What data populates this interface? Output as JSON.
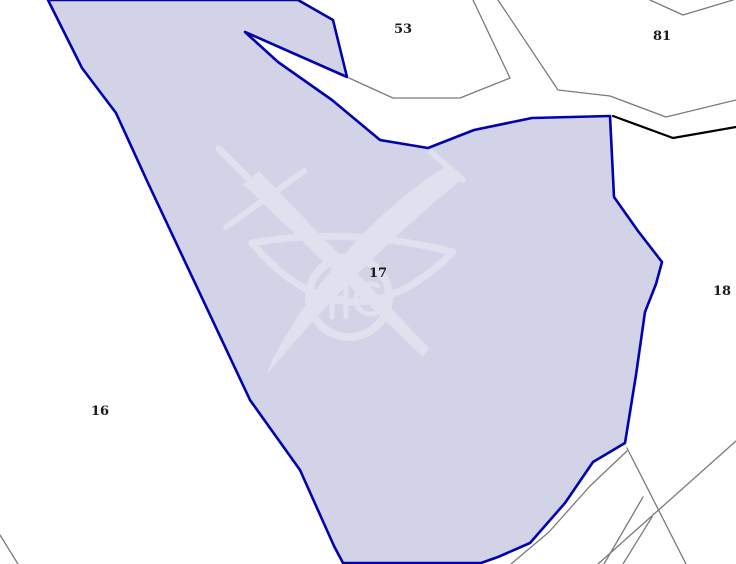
{
  "map": {
    "width": 736,
    "height": 564,
    "background_color": "#ffffff",
    "colors": {
      "parcel_fill": "#d2d3e6",
      "parcel_stroke": "#0202ae",
      "boundary_gray": "#7a7a7a",
      "boundary_black": "#000000",
      "label_color": "#1a1a1a",
      "watermark_color": "#dfe1ee"
    },
    "selected_parcel": {
      "id": "17",
      "points": "48,0 298,0 333,20 347,77 245,32 278,62 332,100 380,140 428,148 474,130 532,118 610,116 614,197 638,231 662,262 656,284 645,312 636,375 625,443 593,462 565,503 530,543 498,557 481,563 343,563 334,546 300,470 250,400 148,183 116,113 82,68",
      "stroke_width": 2.6
    },
    "line_styles": {
      "gray": {
        "color": "#7a7a7a",
        "width": 1.3
      },
      "black": {
        "color": "#000000",
        "width": 2.2
      }
    },
    "boundaries": [
      {
        "name": "parcel-53-boundary",
        "style": "gray",
        "points": "349,78 393,98 460,98 510,78 473,0"
      },
      {
        "name": "road-upper-boundary",
        "style": "gray",
        "points": "498,0 558,90 610,96 666,117 736,100"
      },
      {
        "name": "top-right-notch-boundary",
        "style": "gray",
        "points": "650,0 683,15 733,0"
      },
      {
        "name": "parcel-18-black-boundary",
        "style": "black",
        "points": "613,116 673,138 736,127"
      },
      {
        "name": "bottom-left-corner-boundary",
        "style": "gray",
        "points": "0,535 18,564"
      },
      {
        "name": "road-edge-parallel-boundary",
        "style": "gray",
        "points": "627,451 590,486 549,532 511,564"
      },
      {
        "name": "southeast-branch-boundary",
        "style": "gray",
        "points": "627,448 686,564"
      },
      {
        "name": "narrow-strip-west-boundary",
        "style": "gray",
        "points": "643,497 604,564"
      },
      {
        "name": "narrow-strip-east-boundary",
        "style": "gray",
        "points": "652,517 623,564"
      },
      {
        "name": "southeast-diagonal-boundary",
        "style": "gray",
        "points": "736,441 598,564"
      }
    ],
    "labels": [
      {
        "id": "53",
        "text": "53",
        "x": 403,
        "y": 33
      },
      {
        "id": "81",
        "text": "81",
        "x": 662,
        "y": 40
      },
      {
        "id": "17",
        "text": "17",
        "x": 378,
        "y": 277
      },
      {
        "id": "16",
        "text": "16",
        "x": 100,
        "y": 415
      },
      {
        "id": "18",
        "text": "18",
        "x": 722,
        "y": 295
      }
    ],
    "label_style": {
      "font_size": 13
    },
    "watermark": {
      "icon_name": "crossed-sword-saber-emblem-icon",
      "shapes": [
        {
          "kind": "stroke",
          "d": "M219,149 L247,177",
          "width": 7
        },
        {
          "kind": "stroke",
          "d": "M304,171 L226,227",
          "width": 6
        },
        {
          "kind": "fill",
          "d": "M243,184 L259,171 L429,348 L423,357 Z"
        },
        {
          "kind": "fill",
          "d": "M446,166 Q340,234 272,360 L267,374 Q362,260 460,181 Z"
        },
        {
          "kind": "stroke",
          "d": "M431,152 L463,180",
          "width": 6
        },
        {
          "kind": "stroke",
          "d": "M252,243 Q350,226 453,252",
          "width": 7
        },
        {
          "kind": "stroke",
          "d": "M252,243 Q348,356 453,252",
          "width": 7
        },
        {
          "kind": "circle",
          "cx": 349,
          "cy": 297,
          "r": 40,
          "width": 8
        },
        {
          "kind": "stroke",
          "d": "M332,279 L332,317 M346,279 L346,317 M332,298 L346,298",
          "width": 5
        },
        {
          "kind": "stroke",
          "d": "M378,286 A15,15 0 1 0 378,312 M366,299 L378,299",
          "width": 5
        }
      ]
    }
  }
}
